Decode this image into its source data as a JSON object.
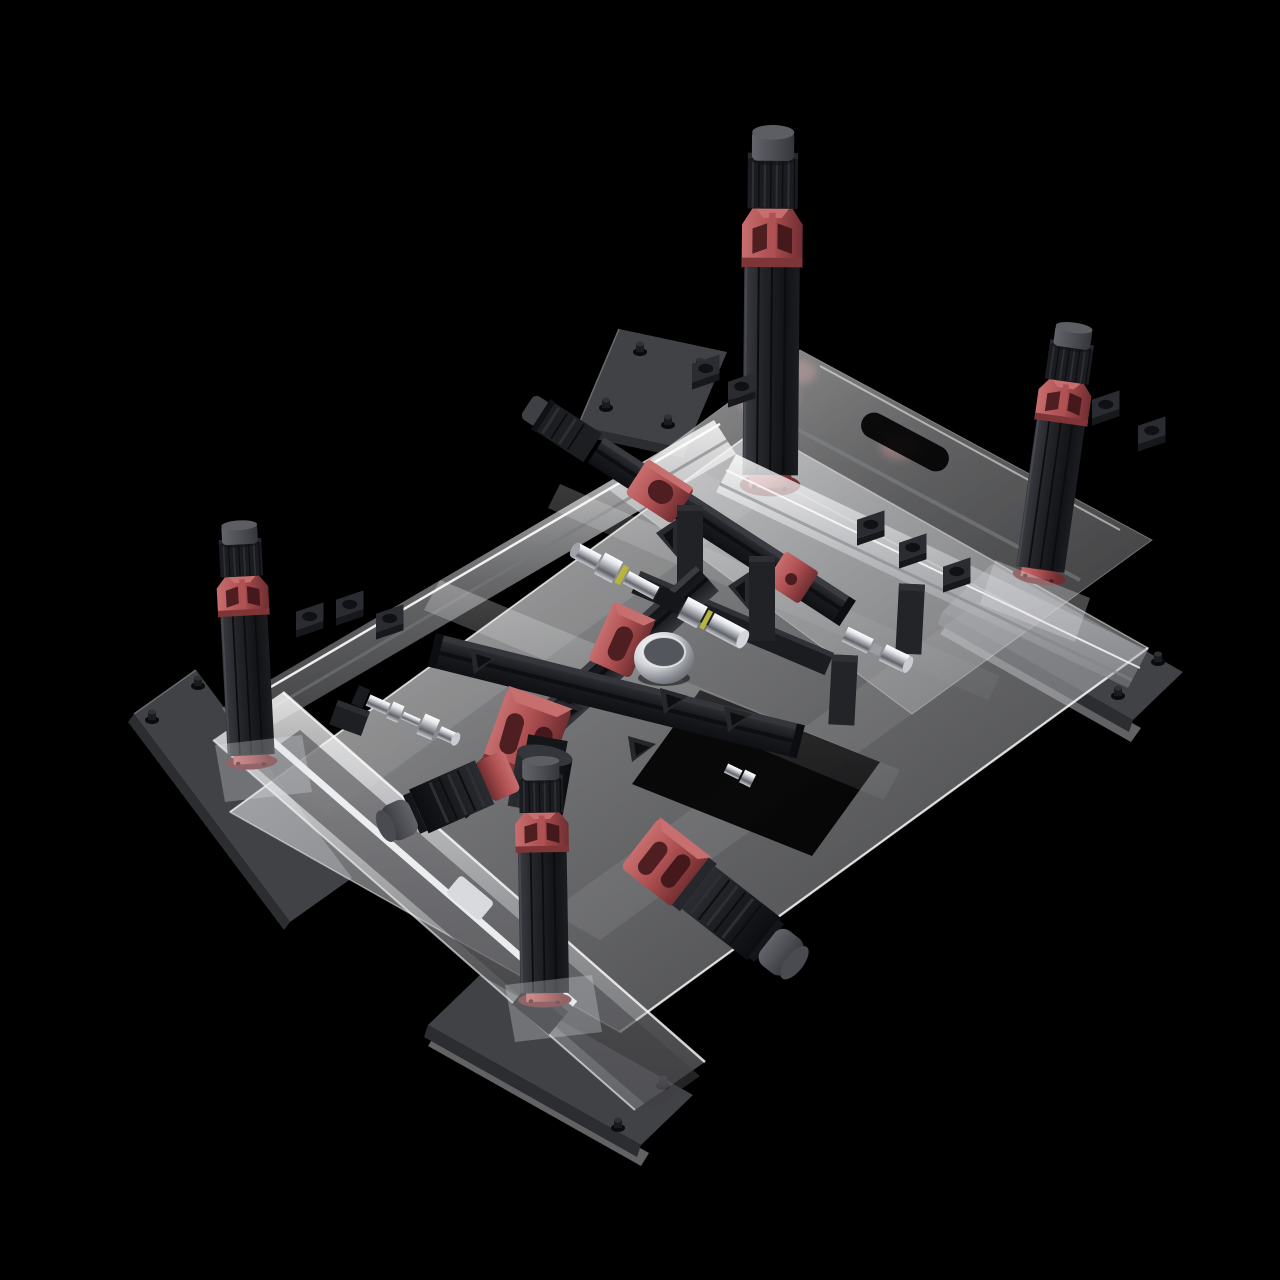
{
  "scene": {
    "description": "photorealistic 3d render, isometric view, four-post vertical actuator test rig",
    "background": "#000000",
    "machine": "gantry-test-rig",
    "text_content": ""
  },
  "palette": {
    "bg": "#000000",
    "plate": "#414246",
    "plate_dark": "#2c2d30",
    "screw": "#131416",
    "black_part": "#1e1f23",
    "black_part_light": "#31323a",
    "black_part_dark": "#0e0f12",
    "red_main": "#b05153",
    "red_light": "#c76e6e",
    "red_dark": "#7e3537",
    "red_hole": "#4f1e21",
    "cap_gray": "#54555b",
    "glass_light": "#e4e5e8",
    "glass_mid": "#b9babe",
    "chrome_highlight": "#f4f5f7",
    "accent_yellow": "#b8b43e"
  },
  "components": {
    "towers": [
      {
        "id": "tower-top",
        "type": "vertical-actuator-column"
      },
      {
        "id": "tower-right",
        "type": "vertical-actuator-column"
      },
      {
        "id": "tower-left",
        "type": "vertical-actuator-column"
      },
      {
        "id": "tower-bottom",
        "type": "vertical-actuator-column"
      }
    ],
    "feet": [
      {
        "id": "outrigger-plate-top",
        "screws": 4
      },
      {
        "id": "outrigger-plate-right",
        "screws": 2
      },
      {
        "id": "outrigger-plate-bottom",
        "screws": 2
      },
      {
        "id": "outrigger-plate-left",
        "screws": 2
      }
    ],
    "base": {
      "id": "translucent-base-plate",
      "slots": 2,
      "cutouts": 2
    },
    "gantry": {
      "id": "upper-gantry-beam",
      "slider": "red-carriage",
      "end_block": "red-block",
      "motor": "stepper-motor"
    },
    "cross": {
      "id": "center-cross-beams",
      "clamp": "red-clamp-block",
      "motor": "vertical-stepper-motor"
    },
    "actuators": [
      {
        "id": "horizontal-actuator-right",
        "parts": [
          "red-bracket",
          "motor-body",
          "end-cap"
        ]
      },
      {
        "id": "horizontal-actuator-left",
        "parts": [
          "red-bracket",
          "motor-body",
          "end-cap"
        ]
      }
    ],
    "shafts": [
      {
        "id": "chrome-shaft-main",
        "rings": "yellow-retainer-rings"
      },
      {
        "id": "chrome-shaft-lower-left"
      },
      {
        "id": "chrome-coupling-right"
      },
      {
        "id": "chrome-bowl"
      }
    ]
  }
}
